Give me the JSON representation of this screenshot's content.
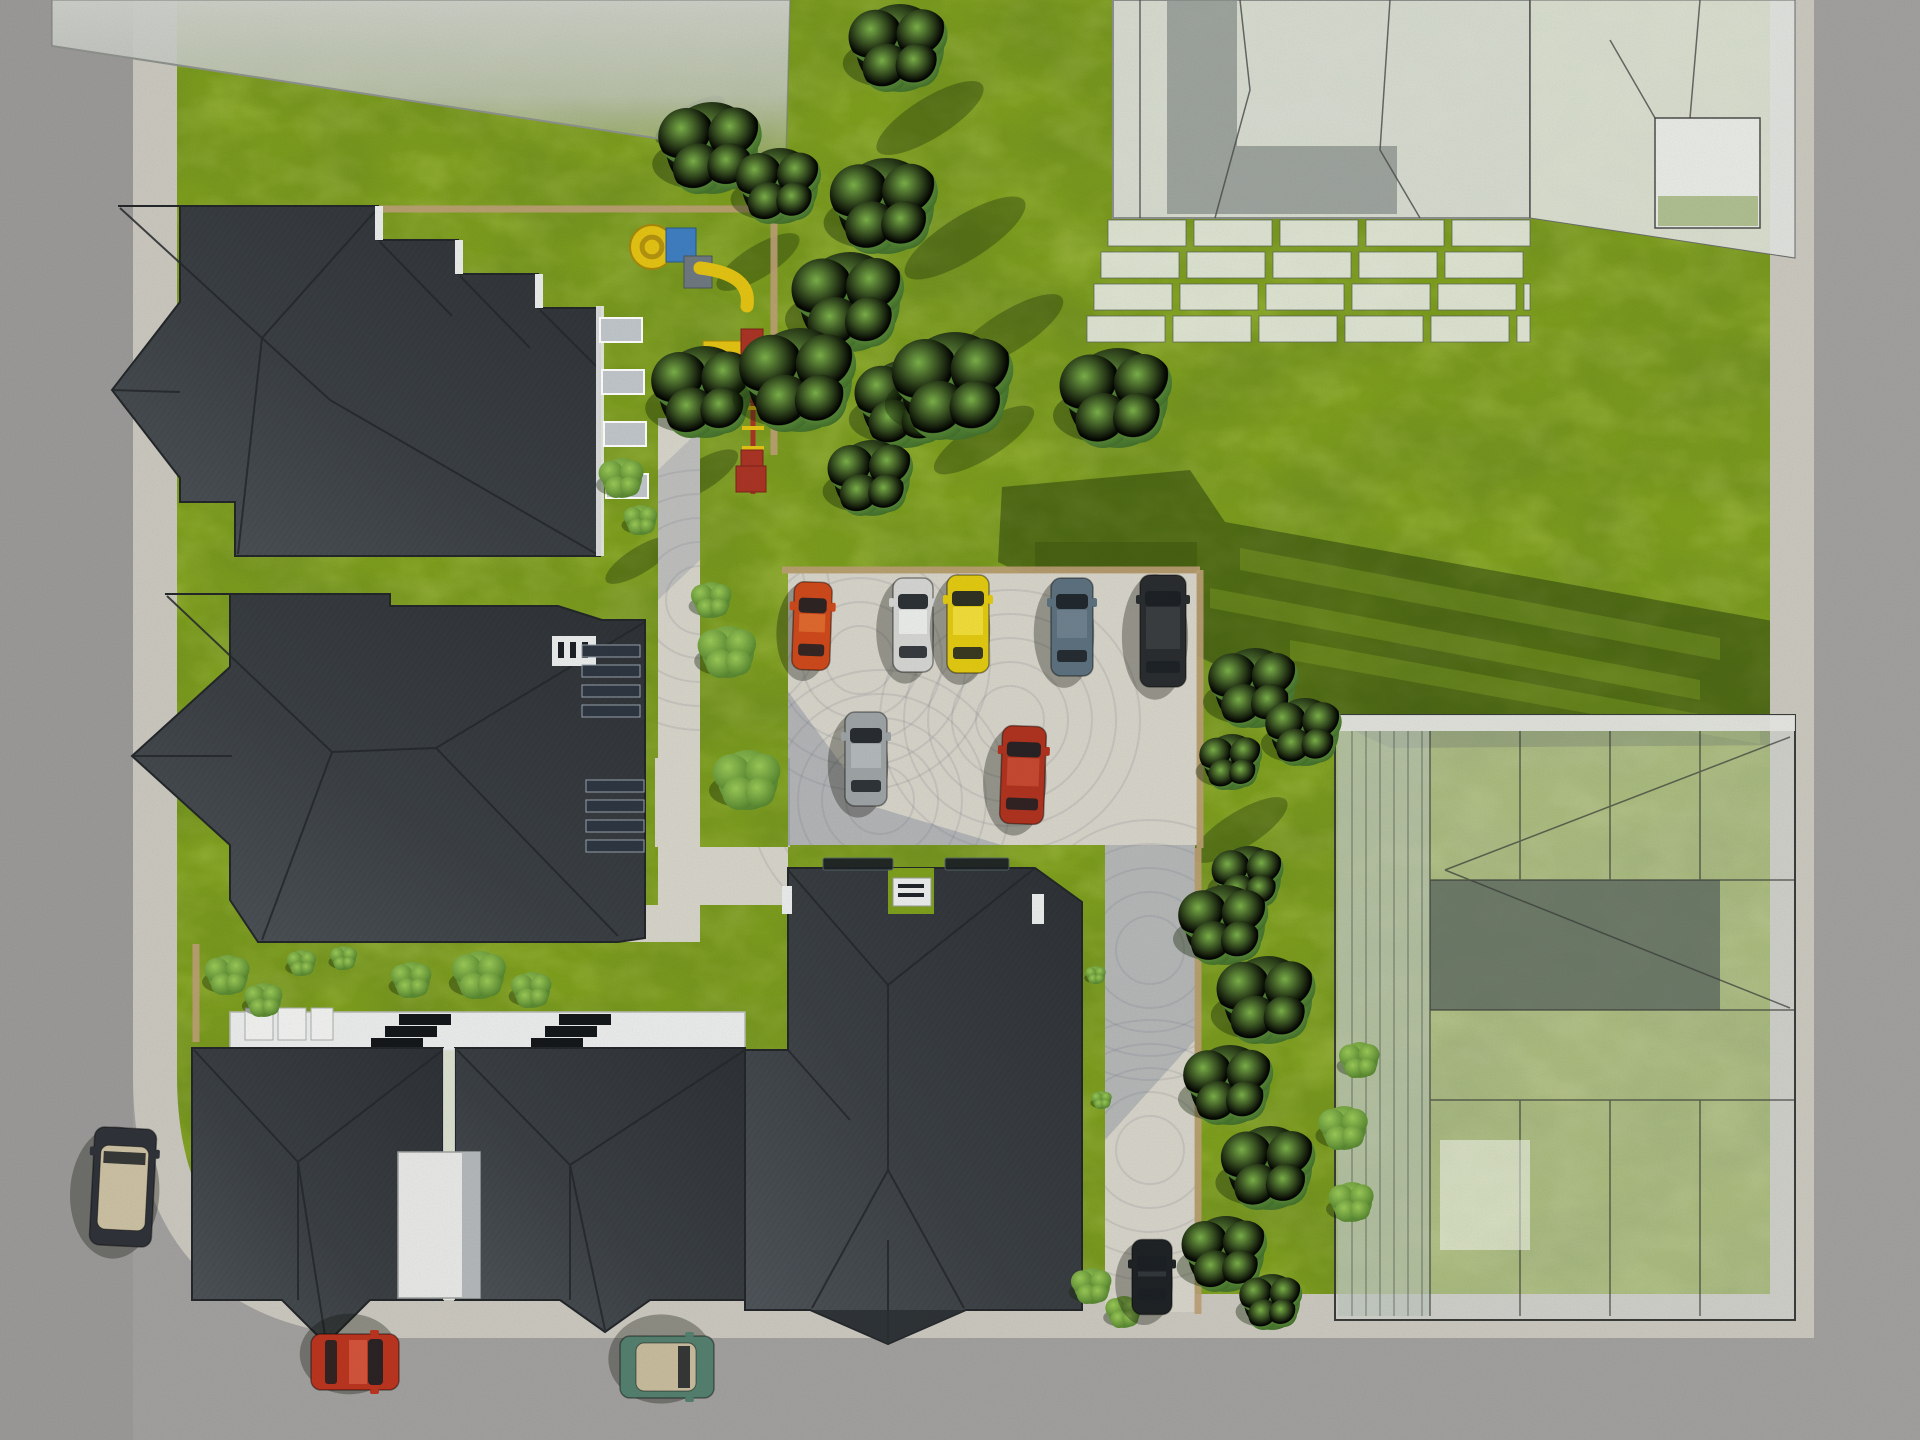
{
  "scene": {
    "description": "Top-down aerial 3D architectural rendering of a residential site plan: dark hip-roof apartment houses on the left and bottom, translucent massing-model towers at the top right, a glass building at the bottom right, green lawn with trees, a cobblestone parking lot with parked cars, playground, and surrounding gray roads.",
    "palette": {
      "road": "#a3a2a0",
      "road_left": "#9c9b9a",
      "sidewalk": "#ccc9c0",
      "curb_tan": "#bfa178",
      "grass": "#7fa01e",
      "grass_dark": "#465f12",
      "path_cobble": "#d8d5cb",
      "path_shadow": "#5f6e8a",
      "roof_dark": "#383c40",
      "roof_edge": "#25282b",
      "wall_white": "#eceded",
      "balcony_gray": "#c2c7cb",
      "tower_fill": "#dfe1de",
      "tower_shade": "#8b918e",
      "glass_line": "#3a3d3a",
      "courtyard_dark": "#5f6a62",
      "tree_green": "#4e7d32",
      "bush_green": "#6fae3d",
      "shadow_green": "rgba(22,42,8,0.42)",
      "playground_yellow": "#e5c414",
      "playground_red": "#ab3526",
      "playground_blue": "#3f7fc2",
      "panel_dark": "#2e3742"
    }
  },
  "objects": {
    "cars": [
      {
        "name": "orange-hatchback",
        "x": 812,
        "y": 626,
        "w": 38,
        "l": 88,
        "rot": 2,
        "color": "#cf4a1c",
        "roof": "#e06a2e"
      },
      {
        "name": "silver-sedan",
        "x": 913,
        "y": 625,
        "w": 40,
        "l": 94,
        "rot": 0,
        "color": "#d6d7d4",
        "roof": "#eceeec"
      },
      {
        "name": "yellow-sedan",
        "x": 968,
        "y": 624,
        "w": 42,
        "l": 98,
        "rot": 0,
        "color": "#e3cb12",
        "roof": "#f2df3a"
      },
      {
        "name": "steel-blue-sedan",
        "x": 1072,
        "y": 627,
        "w": 42,
        "l": 98,
        "rot": 0,
        "color": "#5d7280",
        "roof": "#70828f"
      },
      {
        "name": "black-suv",
        "x": 1163,
        "y": 631,
        "w": 46,
        "l": 112,
        "rot": 0,
        "color": "#2b2e30",
        "roof": "#3a3e41"
      },
      {
        "name": "gray-hatchback",
        "x": 866,
        "y": 759,
        "w": 42,
        "l": 94,
        "rot": 0,
        "color": "#9fa5a6",
        "roof": "#b4babb"
      },
      {
        "name": "red-sedan",
        "x": 1023,
        "y": 775,
        "w": 44,
        "l": 98,
        "rot": 2,
        "color": "#b03420",
        "roof": "#c84a32"
      },
      {
        "name": "black-car-on-path",
        "x": 1152,
        "y": 1277,
        "w": 40,
        "l": 75,
        "rot": 0,
        "color": "#202326",
        "roof": "#33383c"
      },
      {
        "name": "dark-convertible-left-road",
        "x": 123,
        "y": 1187,
        "w": 62,
        "l": 118,
        "rot": 3,
        "color": "#30343a",
        "interior": "#cdc2a4"
      },
      {
        "name": "red-city-car",
        "x": 355,
        "y": 1362,
        "w": 56,
        "l": 88,
        "rot": 90,
        "color": "#bc3620",
        "roof": "#d4553c"
      },
      {
        "name": "teal-convertible",
        "x": 667,
        "y": 1367,
        "w": 62,
        "l": 94,
        "rot": 90,
        "color": "#55806f",
        "interior": "#c9bd9e"
      }
    ],
    "trees": [
      [
        712,
        148,
        46
      ],
      [
        780,
        186,
        38
      ],
      [
        900,
        48,
        44
      ],
      [
        886,
        206,
        48
      ],
      [
        850,
        302,
        50
      ],
      [
        906,
        404,
        44
      ],
      [
        872,
        478,
        38
      ],
      [
        705,
        392,
        46
      ],
      [
        800,
        380,
        52
      ],
      [
        955,
        386,
        54
      ],
      [
        1118,
        398,
        50
      ],
      [
        1255,
        688,
        40
      ],
      [
        1305,
        732,
        34
      ],
      [
        1232,
        762,
        28
      ],
      [
        1249,
        878,
        32
      ],
      [
        1225,
        925,
        40
      ],
      [
        1268,
        1000,
        44
      ],
      [
        1230,
        1085,
        40
      ],
      [
        1270,
        1168,
        42
      ],
      [
        1226,
        1254,
        38
      ],
      [
        1272,
        1302,
        28
      ]
    ],
    "bushes": [
      [
        728,
        652,
        26
      ],
      [
        712,
        600,
        18
      ],
      [
        748,
        780,
        30
      ],
      [
        622,
        478,
        20
      ],
      [
        641,
        520,
        15
      ],
      [
        228,
        975,
        20
      ],
      [
        264,
        1000,
        17
      ],
      [
        302,
        963,
        13
      ],
      [
        344,
        958,
        12
      ],
      [
        412,
        980,
        18
      ],
      [
        480,
        975,
        24
      ],
      [
        532,
        990,
        18
      ],
      [
        1344,
        1128,
        22
      ],
      [
        1352,
        1202,
        20
      ],
      [
        1092,
        1286,
        18
      ],
      [
        1124,
        1312,
        16
      ],
      [
        1360,
        1060,
        18
      ],
      [
        1096,
        975,
        9
      ],
      [
        1102,
        1100,
        9
      ]
    ],
    "tree_shadows": [
      [
        930,
        118,
        62,
        20,
        -32
      ],
      [
        965,
        238,
        70,
        22,
        -32
      ],
      [
        1008,
        332,
        64,
        20,
        -32
      ],
      [
        758,
        262,
        48,
        16,
        -32
      ],
      [
        700,
        476,
        44,
        15,
        -32
      ],
      [
        984,
        440,
        58,
        18,
        -32
      ],
      [
        690,
        120,
        40,
        14,
        -32
      ],
      [
        1240,
        830,
        55,
        18,
        -32
      ],
      [
        640,
        560,
        40,
        13,
        -32
      ]
    ],
    "shadow_stripes": [
      "1240,548 1720,638 1720,660 1240,570",
      "1210,588 1700,680 1700,700 1210,608",
      "1290,640 1760,725 1760,744 1290,660"
    ],
    "tower_balconies": {
      "x": 1108,
      "y": 220,
      "rows": 4,
      "rowH": 32,
      "width": 422,
      "slabW": 78,
      "gap": 8,
      "dxPerRow": -7
    },
    "roofA_balconies": {
      "x": 600,
      "y": 318,
      "count": 4,
      "dy": 52,
      "w": 42,
      "h": 24
    },
    "solar_panels": [
      {
        "x": 582,
        "y": 645,
        "w": 58,
        "rows": 4,
        "rowH": 20
      },
      {
        "x": 586,
        "y": 780,
        "w": 58,
        "rows": 4,
        "rowH": 20
      }
    ],
    "skylights": [
      {
        "x": 399,
        "y": 1014,
        "n": 3,
        "dx": -14,
        "dy": 12,
        "w": 52,
        "h": 11
      },
      {
        "x": 559,
        "y": 1014,
        "n": 3,
        "dx": -14,
        "dy": 12,
        "w": 52,
        "h": 11
      }
    ],
    "roof_vents": [
      [
        823,
        858,
        70,
        12
      ],
      [
        945,
        858,
        64,
        12
      ]
    ],
    "terraces": [
      [
        245,
        1008,
        28,
        32
      ],
      [
        278,
        1008,
        28,
        32
      ],
      [
        311,
        1008,
        22,
        32
      ]
    ],
    "curbs": [
      [
        782,
        570,
        1200,
        570
      ],
      [
        1200,
        570,
        1200,
        848
      ],
      [
        1198,
        848,
        1198,
        1314
      ]
    ],
    "fences": [
      [
        325,
        209,
        778,
        209
      ],
      [
        774,
        209,
        774,
        455
      ],
      [
        196,
        944,
        196,
        1042
      ]
    ],
    "playground": {
      "fence_note": "wood frame play structures on lawn",
      "spiral_slide": {
        "cx": 652,
        "cy": 247,
        "r": 22
      },
      "blue_box": {
        "x": 666,
        "y": 228,
        "w": 30,
        "h": 34
      },
      "platform": {
        "x": 684,
        "y": 256,
        "w": 28,
        "h": 32
      },
      "slide_curve": "M700,268 Q752,274 747,306",
      "mini_slide": {
        "x": 703,
        "y": 341,
        "w": 42,
        "h": 15
      },
      "red_box": {
        "x": 741,
        "y": 329,
        "w": 22,
        "h": 26
      },
      "frame": {
        "x": 753,
        "y1": 355,
        "y2": 494
      },
      "rungs": [
        368,
        388,
        408,
        428,
        448,
        468,
        488
      ],
      "seats": [
        [
          744,
          390,
          16,
          12
        ],
        [
          741,
          450,
          22,
          18
        ],
        [
          736,
          466,
          30,
          26
        ]
      ]
    },
    "cobble_arcs": {
      "centers": [
        [
          860,
          660
        ],
        [
          1010,
          720
        ],
        [
          880,
          800
        ],
        [
          1150,
          950
        ],
        [
          1150,
          1150
        ],
        [
          700,
          600
        ]
      ],
      "radii": [
        34,
        58,
        82,
        106,
        130
      ]
    }
  }
}
